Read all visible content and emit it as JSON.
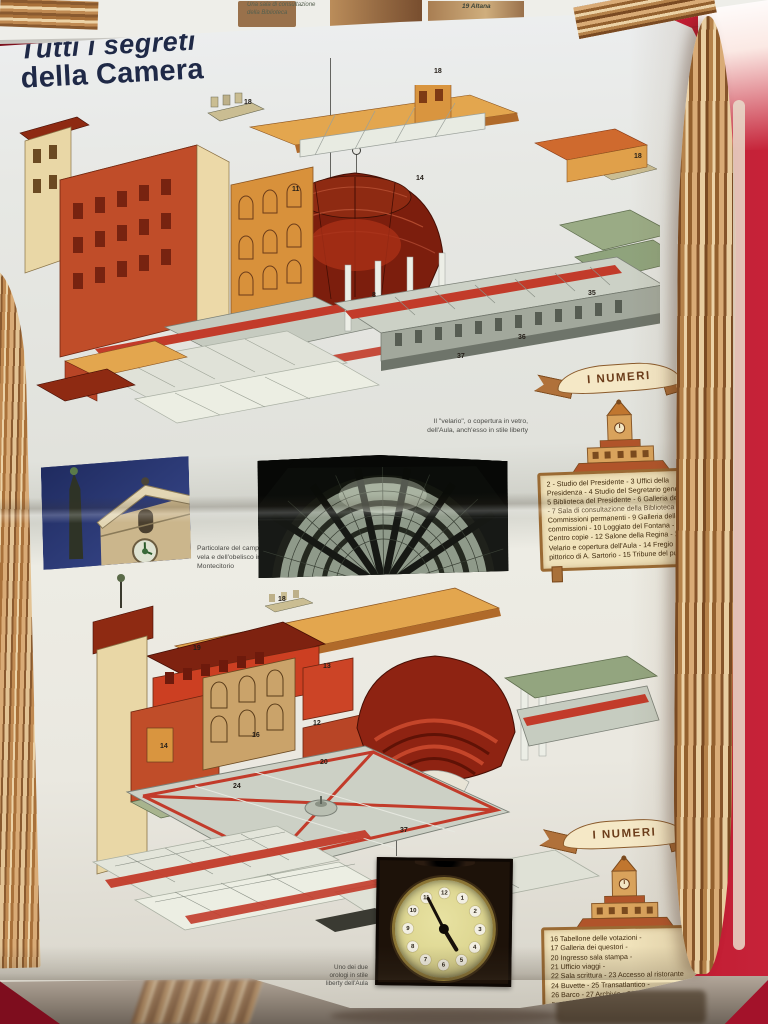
{
  "scene": {
    "table_color": "#b5152b",
    "paper_color": "#e7e8e4"
  },
  "top_edge": {
    "caption": "Una sala di consultazione della Biblioteca",
    "label": "19 Altana"
  },
  "title": {
    "line1": "Tutti i segreti",
    "line2": "della Camera"
  },
  "upper": {
    "callouts": [
      "18",
      "18",
      "18",
      "11",
      "14",
      "8",
      "35",
      "36",
      "37"
    ],
    "velario_caption_l1": "Il \"velario\", o copertura in vetro,",
    "velario_caption_l2": "dell'Aula, anch'esso in stile liberty",
    "campanile_caption_l1": "Particolare del campanile a",
    "campanile_caption_l2": "vela e dell'obelisco in piazza",
    "campanile_caption_l3": "Montecitorio",
    "numeri_banner": "I NUMERI",
    "legend": "2 - Studio del Presidente - 3 Uffici della Presidenza - 4 Studio del Segretario generale - 5 Biblioteca del Presidente - 6 Galleria dei Busti - 7 Sala di consultazione della Biblioteca - 8 Commissioni permanenti - 9 Galleria delle commissioni - 10 Loggiato del Fontana - 11 Centro copie - 12 Salone della Regina - 13 Velario e copertura dell'Aula - 14 Fregio pittorico di A. Sartorio - 15 Tribune del pubblico"
  },
  "lower": {
    "callouts": [
      "18",
      "19",
      "13",
      "12",
      "16",
      "20",
      "24",
      "14",
      "37"
    ],
    "numeri_banner": "I NUMERI",
    "legend_lines": [
      "16 Tabellone delle votazioni -",
      "17 Galleria dei questori -",
      "20 Ingresso sala stampa -",
      "21 Ufficio viaggi -",
      "22 Sala scrittura - 23 Accesso al ristorante",
      "24 Buvette - 25 Transatlantico -",
      "26 Barco - 27 Archivio - 28 Studi del",
      "Presidente della Camera, del Presidente",
      "del Consiglio, dei Ministri"
    ],
    "clock_caption_l1": "Uno dei due",
    "clock_caption_l2": "orologi in stile",
    "clock_caption_l3": "liberty dell'Aula"
  },
  "clock": {
    "numbers": [
      "12",
      "1",
      "2",
      "3",
      "4",
      "5",
      "6",
      "7",
      "8",
      "9",
      "10",
      "11"
    ]
  }
}
